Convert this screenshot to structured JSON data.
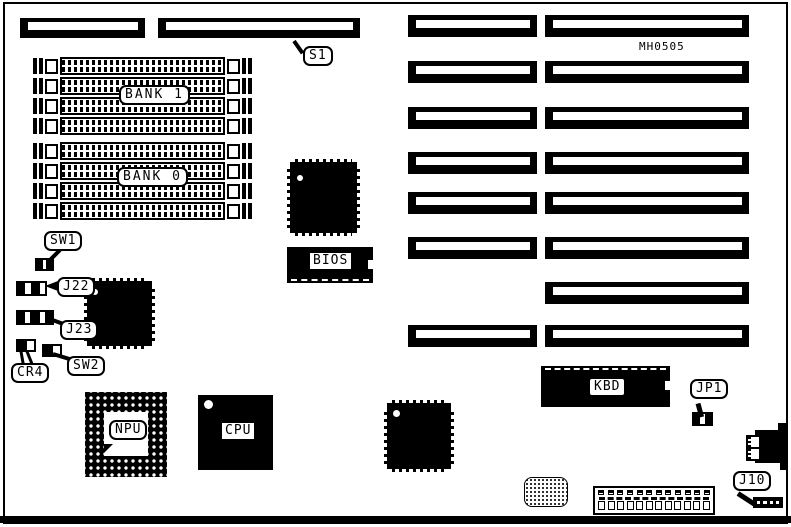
{
  "diagram": {
    "type": "motherboard-layout",
    "board_code": "MH0505"
  },
  "labels": {
    "s1": "S1",
    "bank1": "BANK 1",
    "bank0": "BANK 0",
    "sw1": "SW1",
    "j22": "J22",
    "j23": "J23",
    "cr4": "CR4",
    "sw2": "SW2",
    "bios": "BIOS",
    "npu": "NPU",
    "cpu": "CPU",
    "kbd": "KBD",
    "jp1": "JP1",
    "j10": "J10"
  },
  "memory": {
    "bank1_rows": 4,
    "bank0_rows": 4
  },
  "expansion_slots": {
    "rows": [
      {
        "left": true,
        "right": true
      },
      {
        "left": true,
        "right": true
      },
      {
        "left": true,
        "right": true
      },
      {
        "left": true,
        "right": true
      },
      {
        "left": true,
        "right": true
      },
      {
        "left": true,
        "right": true
      },
      {
        "left": false,
        "right": true
      },
      {
        "left": true,
        "right": true
      }
    ]
  },
  "colors": {
    "ink": "#000000",
    "paper": "#ffffff"
  }
}
